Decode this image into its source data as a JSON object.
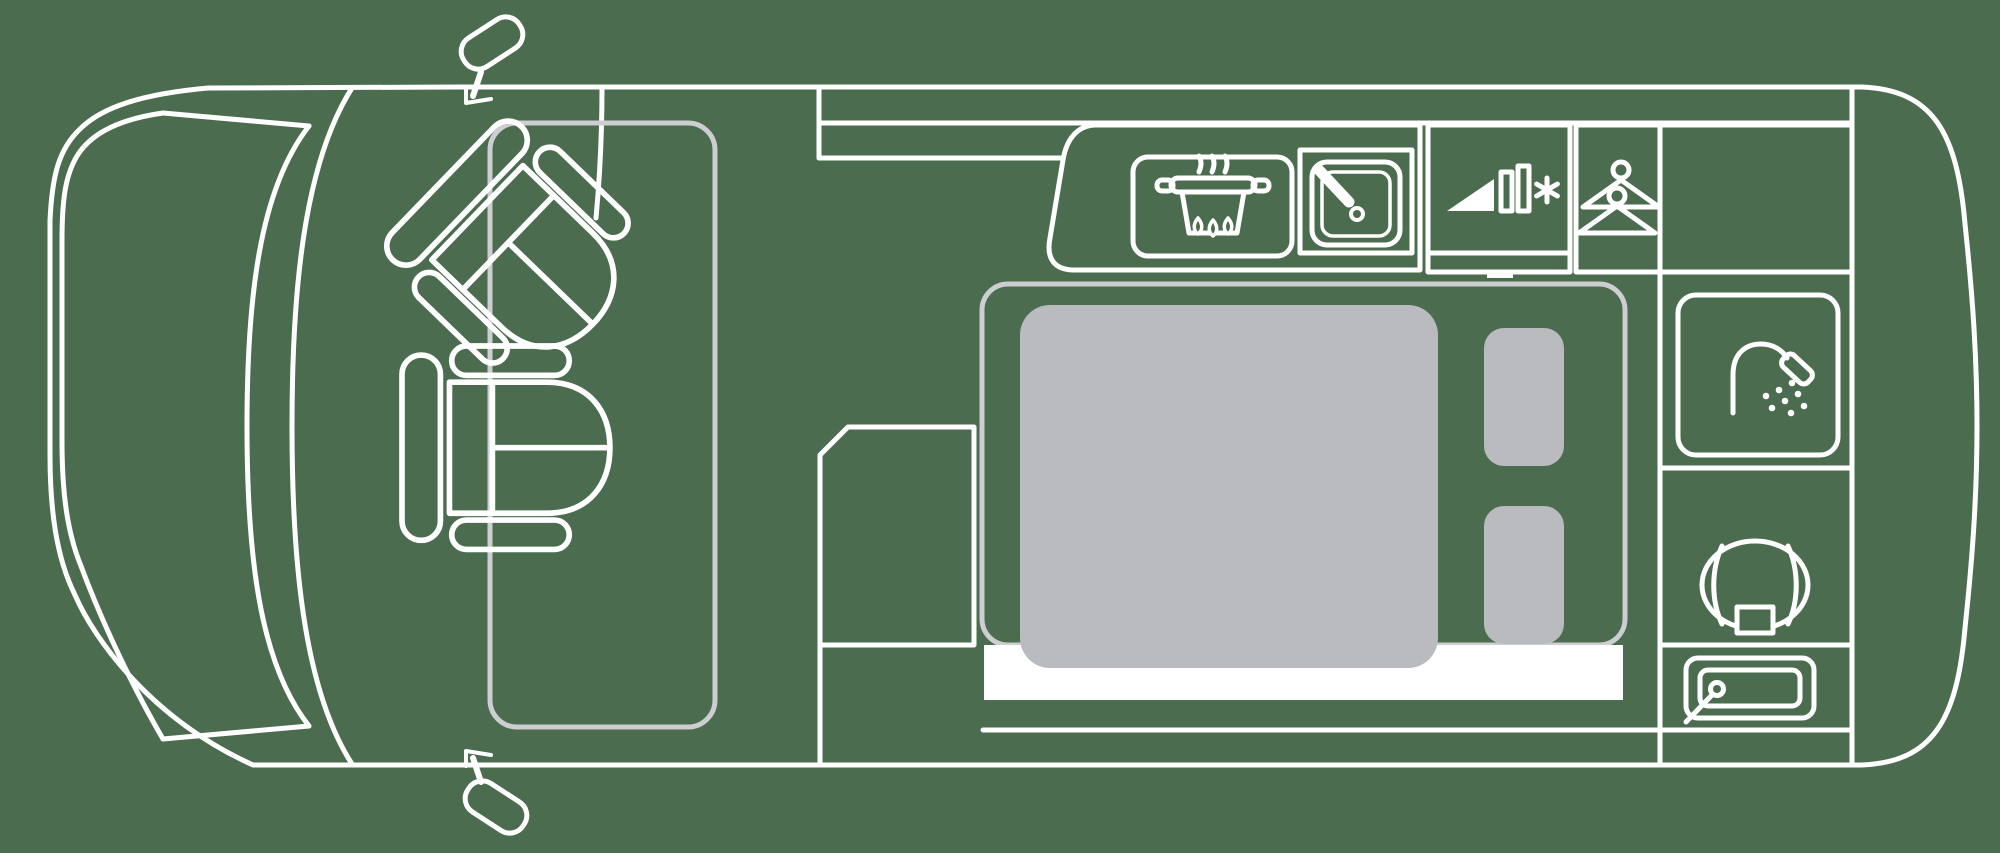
{
  "meta": {
    "description": "Top-down floor plan line drawing of a camper van"
  },
  "colors": {
    "background": "#4b6c4f",
    "line": "#ffffff",
    "soft_line": "#cdced1",
    "furniture_gray": "#b9bbbe"
  },
  "areas": {
    "cab": {
      "label": "driver cab",
      "seats": [
        "front-swivel-seat",
        "rear-swivel-seat"
      ]
    },
    "kitchen": {
      "label": "kitchenette",
      "appliances": [
        "stove",
        "sink"
      ]
    },
    "fridge": {
      "label": "refrigerator with freezer"
    },
    "wardrobe": {
      "label": "wardrobe"
    },
    "rear_storage": {
      "label": "rear storage cabinet"
    },
    "bed": {
      "label": "double bed",
      "pillows": 2
    },
    "bathroom": {
      "label": "bathroom",
      "fixtures": [
        "shower",
        "toilet",
        "washbasin"
      ]
    }
  },
  "icons": [
    "stove-icon",
    "sink-icon",
    "fridge-icon",
    "hangers-icon",
    "shower-icon",
    "toilet-icon",
    "washbasin-icon"
  ]
}
